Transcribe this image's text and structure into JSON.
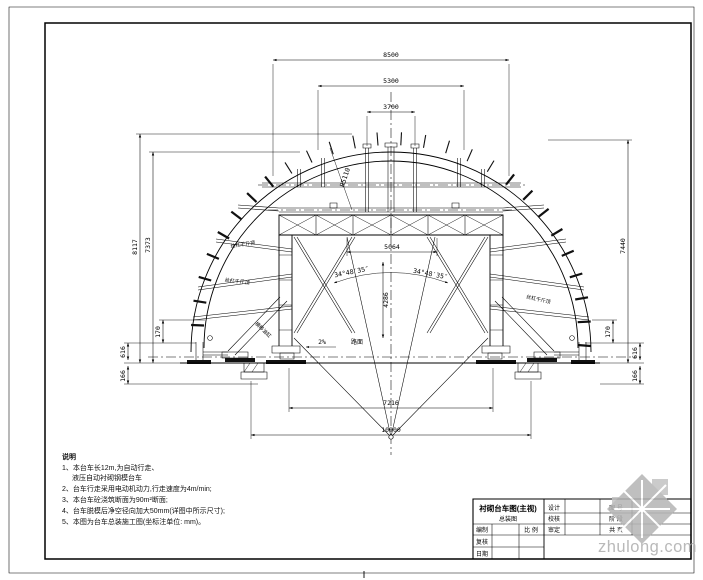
{
  "drawing_title": "衬砌台车图(主视)",
  "dims": {
    "top_outer": "8500",
    "top_middle": "5300",
    "top_inner": "3700",
    "beam_inner": "5064",
    "vault_height": "4286",
    "left_outer": "8117",
    "left_inner": "7373",
    "right_height": "7440",
    "bottom_inner": "7216",
    "bottom_outer": "10000",
    "left_foot": "616",
    "left_travel": "170",
    "left_foundation": "166",
    "right_foot": "616",
    "right_travel": "170",
    "right_foundation": "166",
    "radius": "R5110",
    "angle_left": "34°48′35″",
    "angle_right": "34°48′35″",
    "slope": "2%",
    "road": "路面"
  },
  "labels": {
    "strut_left_upper": "丝杠千斤顶",
    "strut_left_lower": "丝杠千斤顶",
    "strut_right": "丝杠千斤顶",
    "leg_left": "横移油缸"
  },
  "notes": {
    "heading": "说明",
    "lines": [
      "1、本台车长12m,为自动行走、",
      "液压自动衬砌钢模台车",
      "2、台车行走采用电动机动力,行走速度为4m/min;",
      "3、本台车砼浇筑断面为90m²断面;",
      "4、台车脱模后净空径向加大50mm(详图中所示尺寸);",
      "5、本图为台车总装施工图(坐标注单位: mm)。"
    ]
  },
  "title_block": {
    "title": "衬砌台车图(主视)",
    "subtitle": "总装图",
    "left_rows": [
      "编制",
      "复核",
      "日期"
    ],
    "scale": "比 例",
    "mid_rows": [
      "设计",
      "校核",
      "审定"
    ],
    "right_rows": [
      "图 号",
      "阶 段",
      "共 页"
    ]
  },
  "watermark": {
    "text": "zhulong.com"
  }
}
